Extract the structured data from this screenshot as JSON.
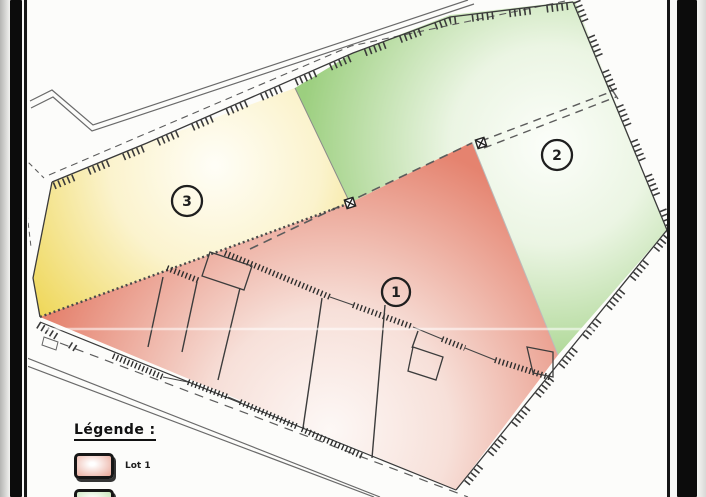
{
  "legend": {
    "title": "Légende :",
    "items": [
      {
        "label": "Lot 1",
        "color": "#e8a596"
      },
      {
        "label": "",
        "color": "#bedfac"
      }
    ]
  },
  "parcels": [
    {
      "number": "1",
      "color": "#e5836f"
    },
    {
      "number": "2",
      "color": "#9ccf7f"
    },
    {
      "number": "3",
      "color": "#eed655"
    }
  ]
}
